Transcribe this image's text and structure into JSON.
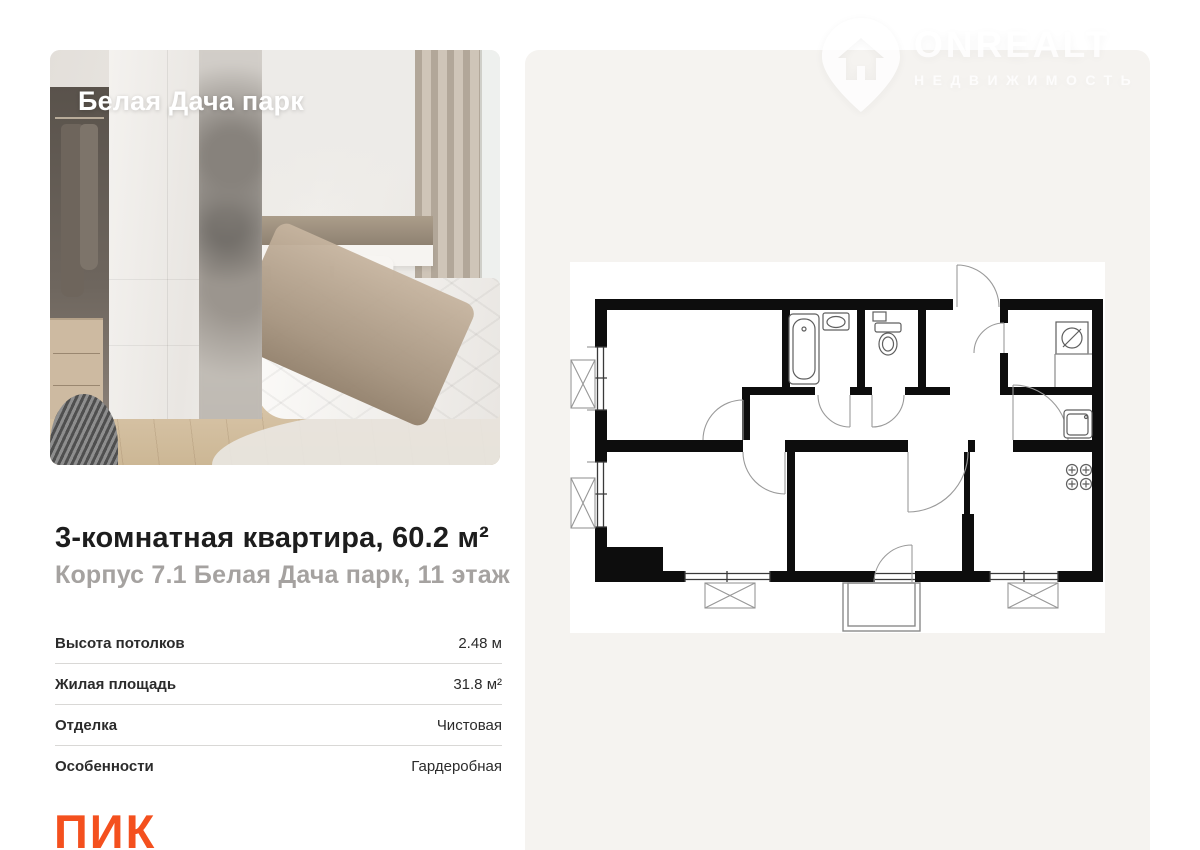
{
  "photo": {
    "overlay_title": "Белая Дача парк"
  },
  "watermark": {
    "brand": "ONREALT",
    "tagline": "НЕДВИЖИМОСТЬ"
  },
  "listing": {
    "title": "3-комнатная квартира, 60.2 м²",
    "subtitle": "Корпус 7.1 Белая Дача парк, 11 этаж"
  },
  "details": {
    "rows": [
      {
        "label": "Высота потолков",
        "value": "2.48 м"
      },
      {
        "label": "Жилая площадь",
        "value": "31.8 м²"
      },
      {
        "label": "Отделка",
        "value": "Чистовая"
      },
      {
        "label": "Особенности",
        "value": "Гардеробная"
      }
    ]
  },
  "developer": {
    "logo_text": "ПИК"
  },
  "floor_plan": {
    "fixture_icons": [
      "bathtub-icon",
      "washbasin-icon",
      "toilet-icon",
      "washing-machine-icon",
      "kitchen-sink-icon",
      "stove-icon",
      "balcony",
      "loggia-box",
      "window",
      "door-arc"
    ]
  },
  "colors": {
    "accent_orange": "#F4501E",
    "panel_gray": "#F5F3F0",
    "wall_black": "#0D0D0D",
    "subtitle_gray": "#A5A2A0"
  }
}
